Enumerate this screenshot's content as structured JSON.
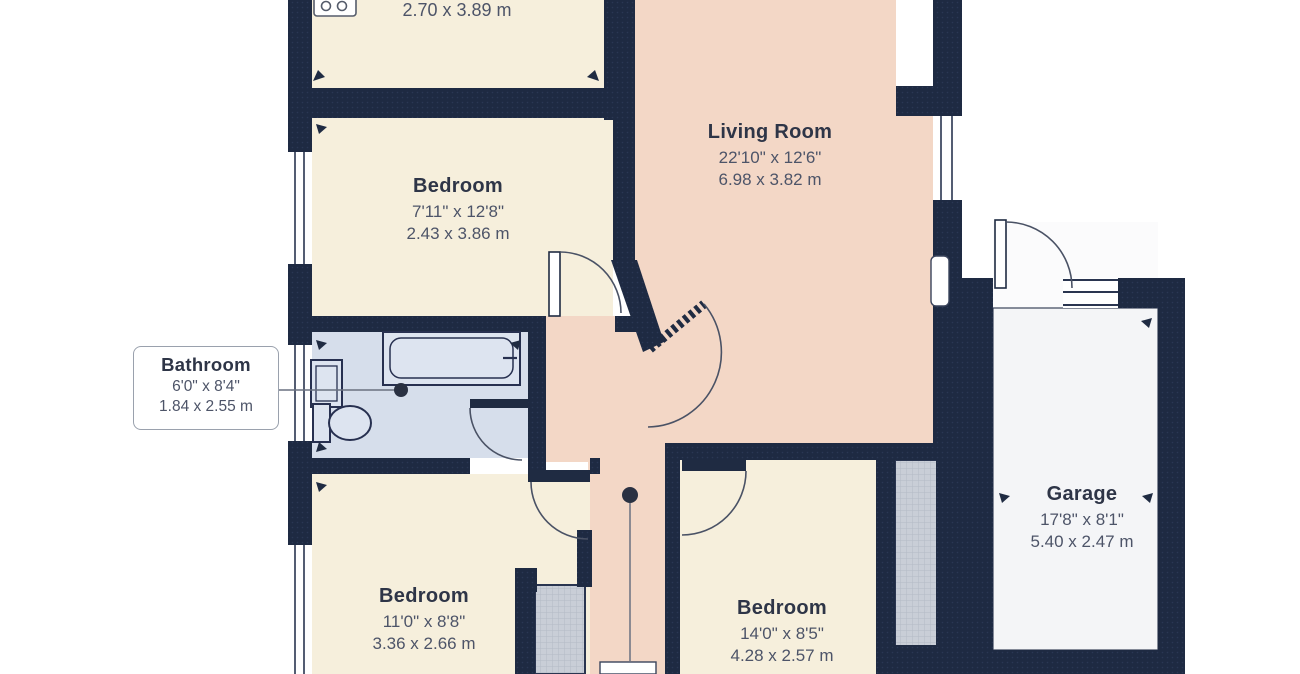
{
  "plan_title": "floor-plan",
  "colors": {
    "wall": "#1e2a42",
    "room_cream": "#f6efdc",
    "room_pink": "#f3d7c6",
    "bathroom_blue": "#d6deeb",
    "garage_grey": "#f4f5f7",
    "closet_grey": "#c9ced7",
    "label_name": "#2e3547",
    "label_dims": "#4d5468",
    "background": "#ffffff"
  },
  "rooms": {
    "kitchen": {
      "name": "",
      "imperial": "",
      "metric": "2.70 x 3.89 m"
    },
    "living": {
      "name": "Living Room",
      "imperial": "22'10\" x 12'6\"",
      "metric": "6.98 x 3.82 m"
    },
    "bedroom1": {
      "name": "Bedroom",
      "imperial": "7'11\" x 12'8\"",
      "metric": "2.43 x 3.86 m"
    },
    "bathroom": {
      "name": "Bathroom",
      "imperial": "6'0\" x 8'4\"",
      "metric": "1.84 x 2.55 m"
    },
    "bedroom2": {
      "name": "Bedroom",
      "imperial": "11'0\" x 8'8\"",
      "metric": "3.36 x 2.66 m"
    },
    "bedroom3": {
      "name": "Bedroom",
      "imperial": "14'0\" x 8'5\"",
      "metric": "4.28 x 2.57 m"
    },
    "garage": {
      "name": "Garage",
      "imperial": "17'8\" x 8'1\"",
      "metric": "5.40 x 2.47 m"
    }
  },
  "icons": [
    "hob-icon"
  ]
}
